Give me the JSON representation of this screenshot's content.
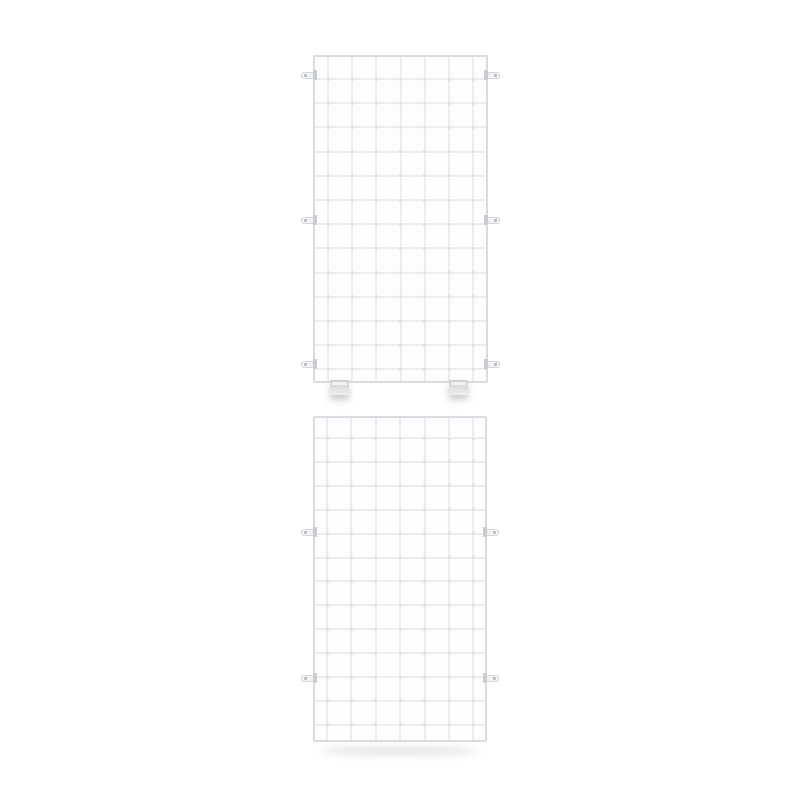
{
  "scene": {
    "type": "product-photo",
    "subject": "Two white wire mesh grid panels on a plain white background",
    "background_color": "#ffffff"
  },
  "palette": {
    "wire": "#ebedee",
    "node": "#e0e3e5",
    "frame": "#d9dde0",
    "tab_fill": "#f0f2f3",
    "tab_border": "#d4d8da",
    "tab_hole": "#b2b7ba",
    "tab_clamp": "#c9cdd0",
    "foot_top": "#cdd1d3",
    "foot_bottom": "#eef0f0",
    "shadow": "rgba(140,148,153,0.45)"
  },
  "tab": {
    "width": 16,
    "height": 7
  },
  "foot": {
    "width": 19,
    "height": 15
  },
  "panels": [
    {
      "name": "grid-panel-upper",
      "x": 313,
      "y": 55,
      "width": 175,
      "height": 328,
      "columns": 8,
      "rows": 14,
      "v_wires": {
        "offset": 15,
        "step": 24.2,
        "count": 7
      },
      "h_wires": {
        "offset": 24,
        "step": 24.2,
        "count": 13
      },
      "side_tabs_y": [
        75,
        220,
        364
      ],
      "feet_x": [
        330,
        449
      ],
      "ground_shadow": false
    },
    {
      "name": "grid-panel-lower",
      "x": 313,
      "y": 416,
      "width": 174,
      "height": 326,
      "columns": 8,
      "rows": 14,
      "v_wires": {
        "offset": 14,
        "step": 24.4,
        "count": 7
      },
      "h_wires": {
        "offset": 22,
        "step": 23.9,
        "count": 13
      },
      "side_tabs_y": [
        532,
        678
      ],
      "feet_x": [],
      "ground_shadow": true
    }
  ]
}
